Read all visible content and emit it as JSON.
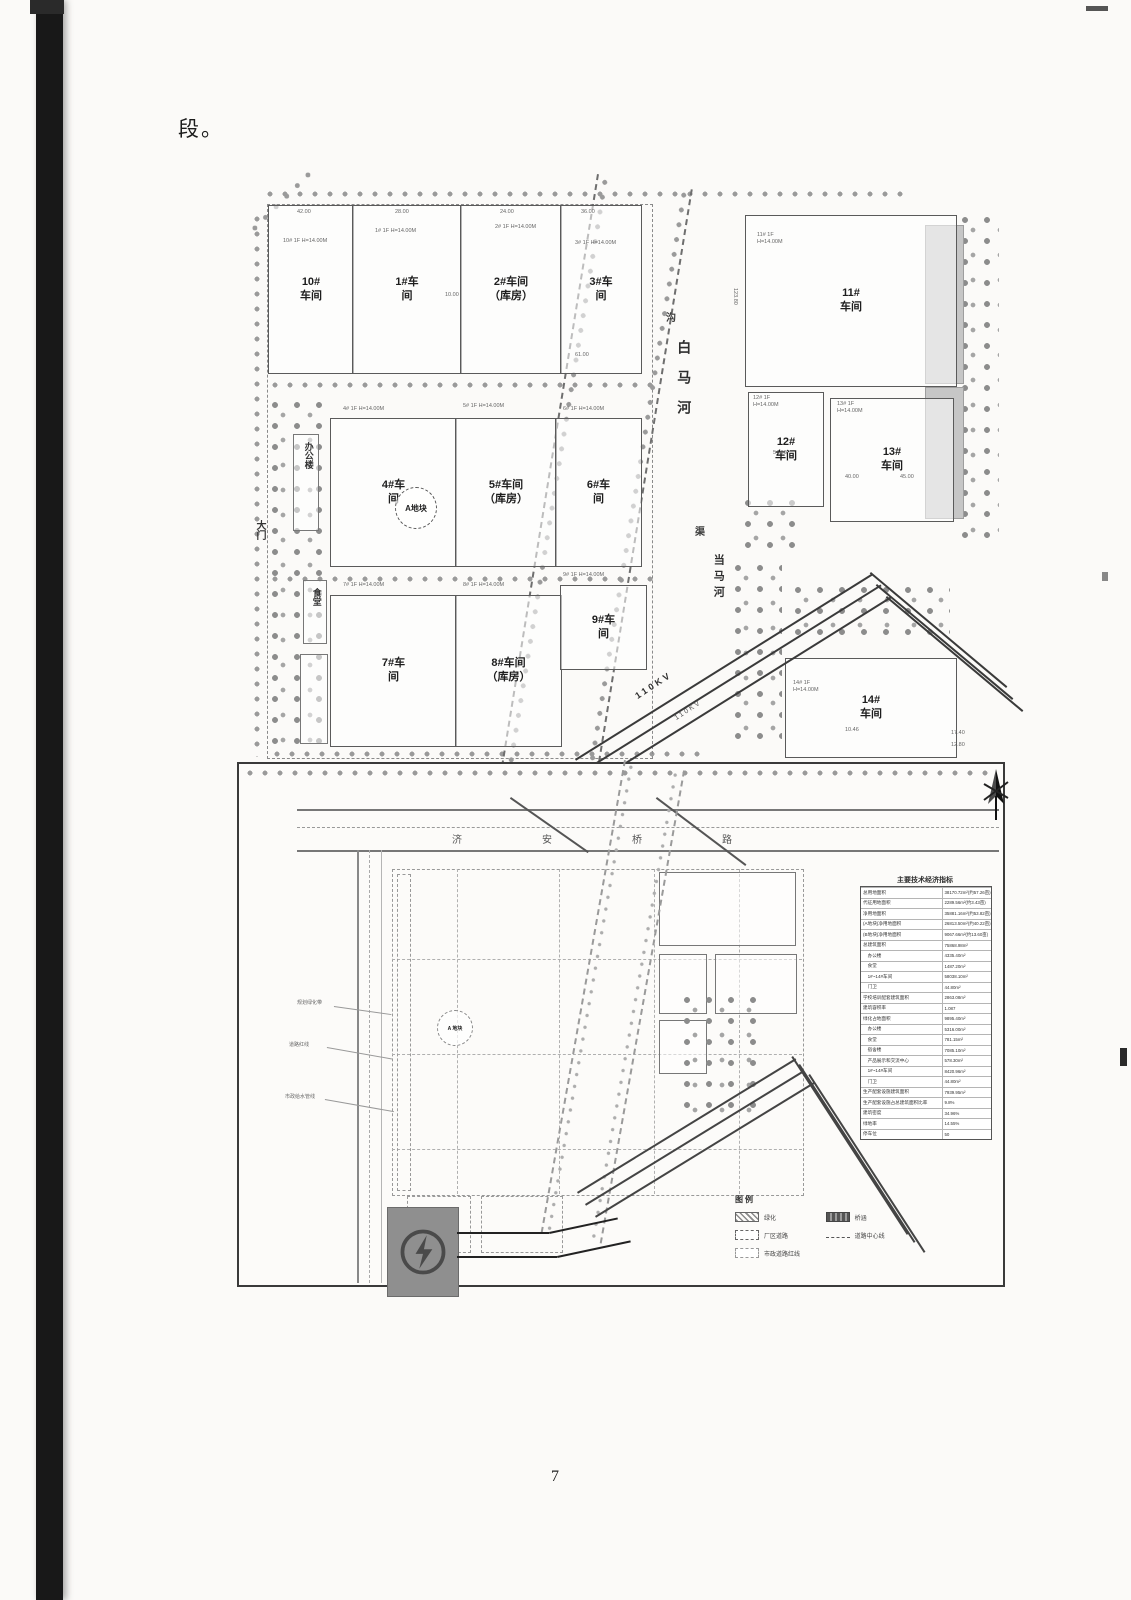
{
  "page": {
    "intro_text": "段。",
    "page_number": "7"
  },
  "figure1": {
    "site_circle": "A地块",
    "buildings": [
      {
        "name": "10#\n车间",
        "style": "left:23px;top:23px;width:84px;height:167px"
      },
      {
        "name": "1#车\n间",
        "style": "left:107px;top:23px;width:108px;height:167px"
      },
      {
        "name": "2#车间\n（库房）",
        "style": "left:215px;top:23px;width:100px;height:167px"
      },
      {
        "name": "3#车\n间",
        "style": "left:315px;top:23px;width:80px;height:167px"
      },
      {
        "name": "4#车\n间",
        "style": "left:85px;top:236px;width:125px;height:147px"
      },
      {
        "name": "5#车间\n（库房）",
        "style": "left:210px;top:236px;width:100px;height:147px"
      },
      {
        "name": "6#车\n间",
        "style": "left:310px;top:236px;width:85px;height:147px"
      },
      {
        "name": "7#车\n间",
        "style": "left:85px;top:413px;width:125px;height:150px"
      },
      {
        "name": "8#车间\n（库房）",
        "style": "left:210px;top:413px;width:105px;height:150px"
      },
      {
        "name": "9#车\n间",
        "style": "left:315px;top:403px;width:85px;height:83px"
      },
      {
        "name": "11#\n车间",
        "style": "left:500px;top:33px;width:210px;height:170px"
      },
      {
        "name": "12#\n车间",
        "style": "left:503px;top:210px;width:74px;height:113px"
      },
      {
        "name": "13#\n车间",
        "style": "left:585px;top:216px;width:122px;height:122px"
      },
      {
        "name": "14#\n车间",
        "style": "left:540px;top:476px;width:170px;height:98px"
      }
    ],
    "annotations": [
      {
        "text": "10# 1F H=14.00M",
        "style": "left:38px;top:56px"
      },
      {
        "text": "1# 1F H=14.00M",
        "style": "left:130px;top:46px"
      },
      {
        "text": "2# 1F H=14.00M",
        "style": "left:250px;top:42px"
      },
      {
        "text": "3# 1F H=14.00M",
        "style": "left:330px;top:58px"
      },
      {
        "text": "4# 1F H=14.00M",
        "style": "left:98px;top:224px"
      },
      {
        "text": "5# 1F H=14.00M",
        "style": "left:218px;top:221px"
      },
      {
        "text": "6# 1F H=14.00M",
        "style": "left:318px;top:224px"
      },
      {
        "text": "7# 1F H=14.00M",
        "style": "left:98px;top:400px"
      },
      {
        "text": "8# 1F H=14.00M",
        "style": "left:218px;top:400px"
      },
      {
        "text": "9# 1F H=14.00M",
        "style": "left:318px;top:390px"
      },
      {
        "text": "11# 1F\nH=14.00M",
        "style": "left:512px;top:50px"
      },
      {
        "text": "12# 1F\nH=14.00M",
        "style": "left:508px;top:213px"
      },
      {
        "text": "13# 1F\nH=14.00M",
        "style": "left:592px;top:219px"
      },
      {
        "text": "14# 1F\nH=14.00M",
        "style": "left:548px;top:498px"
      },
      {
        "text": "沟",
        "style": "left:421px;top:130px;font-size:10px;color:#3c3c3c;font-weight:700"
      },
      {
        "text": "白马河",
        "style": "left:430px;top:158px;writing-mode:vertical-rl;font-size:14px;font-weight:700;letter-spacing:16px;color:#2e2e2e"
      },
      {
        "text": "渠",
        "style": "left:450px;top:344px;font-size:10px;color:#3c3c3c;font-weight:700"
      },
      {
        "text": "当马河",
        "style": "left:466px;top:372px;writing-mode:vertical-rl;font-size:11px;font-weight:700;letter-spacing:5px;color:#2e2e2e"
      },
      {
        "text": "大门",
        "style": "left:8px;top:338px;writing-mode:vertical-rl;font-size:10px;font-weight:700;color:#333"
      },
      {
        "text": "办公楼",
        "style": "left:57px;top:260px;writing-mode:vertical-rl;font-size:9px;font-weight:700;color:#333"
      },
      {
        "text": "食堂",
        "style": "left:65px;top:406px;writing-mode:vertical-rl;font-size:9px;font-weight:700;color:#333"
      },
      {
        "text": "110KV",
        "style": "left:388px;top:498px;transform:rotate(-33deg);font-size:9px;letter-spacing:3px;color:#2f2f2f;font-weight:700"
      },
      {
        "text": "110KV",
        "style": "left:428px;top:524px;transform:rotate(-33deg);font-size:7px;letter-spacing:2px;color:#555"
      },
      {
        "text": "42.00",
        "style": "left:52px;top:27px"
      },
      {
        "text": "28.00",
        "style": "left:150px;top:27px"
      },
      {
        "text": "24.00",
        "style": "left:255px;top:27px"
      },
      {
        "text": "36.00",
        "style": "left:336px;top:27px"
      },
      {
        "text": "10.00",
        "style": "left:200px;top:110px"
      },
      {
        "text": "61.00",
        "style": "left:330px;top:170px"
      },
      {
        "text": "123.80",
        "style": "left:486px;top:106px;writing-mode:vertical-rl"
      },
      {
        "text": "54.00",
        "style": "left:528px;top:268px"
      },
      {
        "text": "40.00",
        "style": "left:600px;top:292px"
      },
      {
        "text": "45.00",
        "style": "left:655px;top:292px"
      },
      {
        "text": "10.46",
        "style": "left:600px;top:545px"
      },
      {
        "text": "17.40",
        "style": "left:706px;top:548px"
      },
      {
        "text": "12.80",
        "style": "left:706px;top:560px"
      }
    ]
  },
  "figure2": {
    "site_circle": "A 地块",
    "annotations": [
      {
        "text": "济安桥路",
        "style": "left:213px;top:70px;font-size:10px;letter-spacing:80px;color:#555"
      },
      {
        "text": "规划绿化带",
        "style": "left:58px;top:236px;font-size:5px;color:#666"
      },
      {
        "text": "道路红线",
        "style": "left:50px;top:278px;font-size:5px;color:#666"
      },
      {
        "text": "市政给水管线",
        "style": "left:46px;top:330px;font-size:5px;color:#666"
      }
    ],
    "table": {
      "title": "主要技术经济指标",
      "rows": [
        {
          "label": "总用地面积",
          "value": "38170.72m²(约57.26亩)"
        },
        {
          "label": "代征用地面积",
          "value": "2289.56m²(约3.43亩)"
        },
        {
          "label": "净用地面积",
          "value": "35881.16m²(约53.82亩)"
        },
        {
          "label": "(A地块)净用地面积",
          "value": "26813.50m²(约40.22亩)"
        },
        {
          "label": "(B地块)净用地面积",
          "value": "9067.66m²(约13.60亩)"
        },
        {
          "label": "总建筑面积",
          "value": "75868.98m²"
        },
        {
          "label": "　办公楼",
          "value": "4335.40m²"
        },
        {
          "label": "　食堂",
          "value": "1487.20m²"
        },
        {
          "label": "　1#~14#车间",
          "value": "58038.10m²"
        },
        {
          "label": "　门卫",
          "value": "44.80m²"
        },
        {
          "label": "学校培训配套建筑面积",
          "value": "2863.08m²"
        },
        {
          "label": "建筑容积率",
          "value": "1.087"
        },
        {
          "label": "绿化占地面积",
          "value": "9895.40m²"
        },
        {
          "label": "　办公楼",
          "value": "5316.00m²"
        },
        {
          "label": "　食堂",
          "value": "781.15m²"
        },
        {
          "label": "　宿舍楼",
          "value": "7085.10m²"
        },
        {
          "label": "　产品展示和交流中心",
          "value": "578.30m²"
        },
        {
          "label": "　1#~14#车间",
          "value": "8420.96m²"
        },
        {
          "label": "　门卫",
          "value": "44.80m²"
        },
        {
          "label": "生产配套设施建筑面积",
          "value": "7939.95m²"
        },
        {
          "label": "生产配套设施占总建筑面积比率",
          "value": "9.8%"
        },
        {
          "label": "建筑密度",
          "value": "34.96%"
        },
        {
          "label": "绿地率",
          "value": "14.55%"
        },
        {
          "label": "停车位",
          "value": "50"
        }
      ]
    },
    "legend": {
      "title": "图例",
      "items": [
        {
          "label": "绿化",
          "swatch": "background:repeating-linear-gradient(45deg,#8a8a8a 0 1.5px,transparent 1.5px 4px);border:1px solid #666"
        },
        {
          "label": "桥涵",
          "swatch": "background:repeating-linear-gradient(90deg,#555 0 3px,#9b9b9b 3px 5px);border:1px solid #444"
        },
        {
          "label": "厂区道路",
          "swatch": "border:1px dashed #666;background:#fff"
        },
        {
          "label": "道路中心线",
          "swatch": "border:none;border-top:1px dashed #555;height:1px;margin-top:4px"
        },
        {
          "label": "市政道路红线",
          "swatch": "border:1px dashed #999;background:#fff"
        }
      ]
    }
  }
}
